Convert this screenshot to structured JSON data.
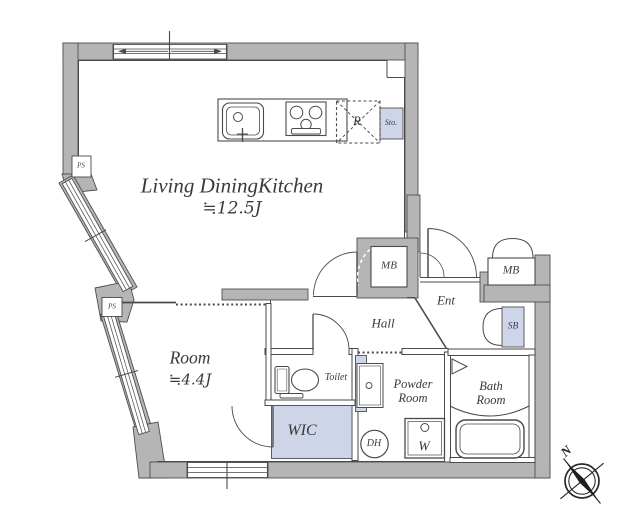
{
  "colors": {
    "wall": "#b5b5b5",
    "line": "#4a4a4a",
    "highlight": "#cfd5e9",
    "text": "#3a3a3a",
    "navy": "#333a5e"
  },
  "labels": {
    "ldk_name": "Living DiningKitchen",
    "ldk_area": "≒12.5J",
    "room_name": "Room",
    "room_area": "≒4.4J",
    "hall": "Hall",
    "entrance": "Ent",
    "toilet": "Toilet",
    "powder_room": "Powder Room",
    "bath_room": "Bath Room",
    "wic": "WIC",
    "washer": "W",
    "dh": "DH",
    "meter_box_left": "MB",
    "meter_box_right": "MB",
    "shoe_box": "SB",
    "storage": "Sto.",
    "refrigerator": "R",
    "pipe_space_upper": "PS",
    "pipe_space_lower": "PS",
    "compass_north": "N"
  }
}
